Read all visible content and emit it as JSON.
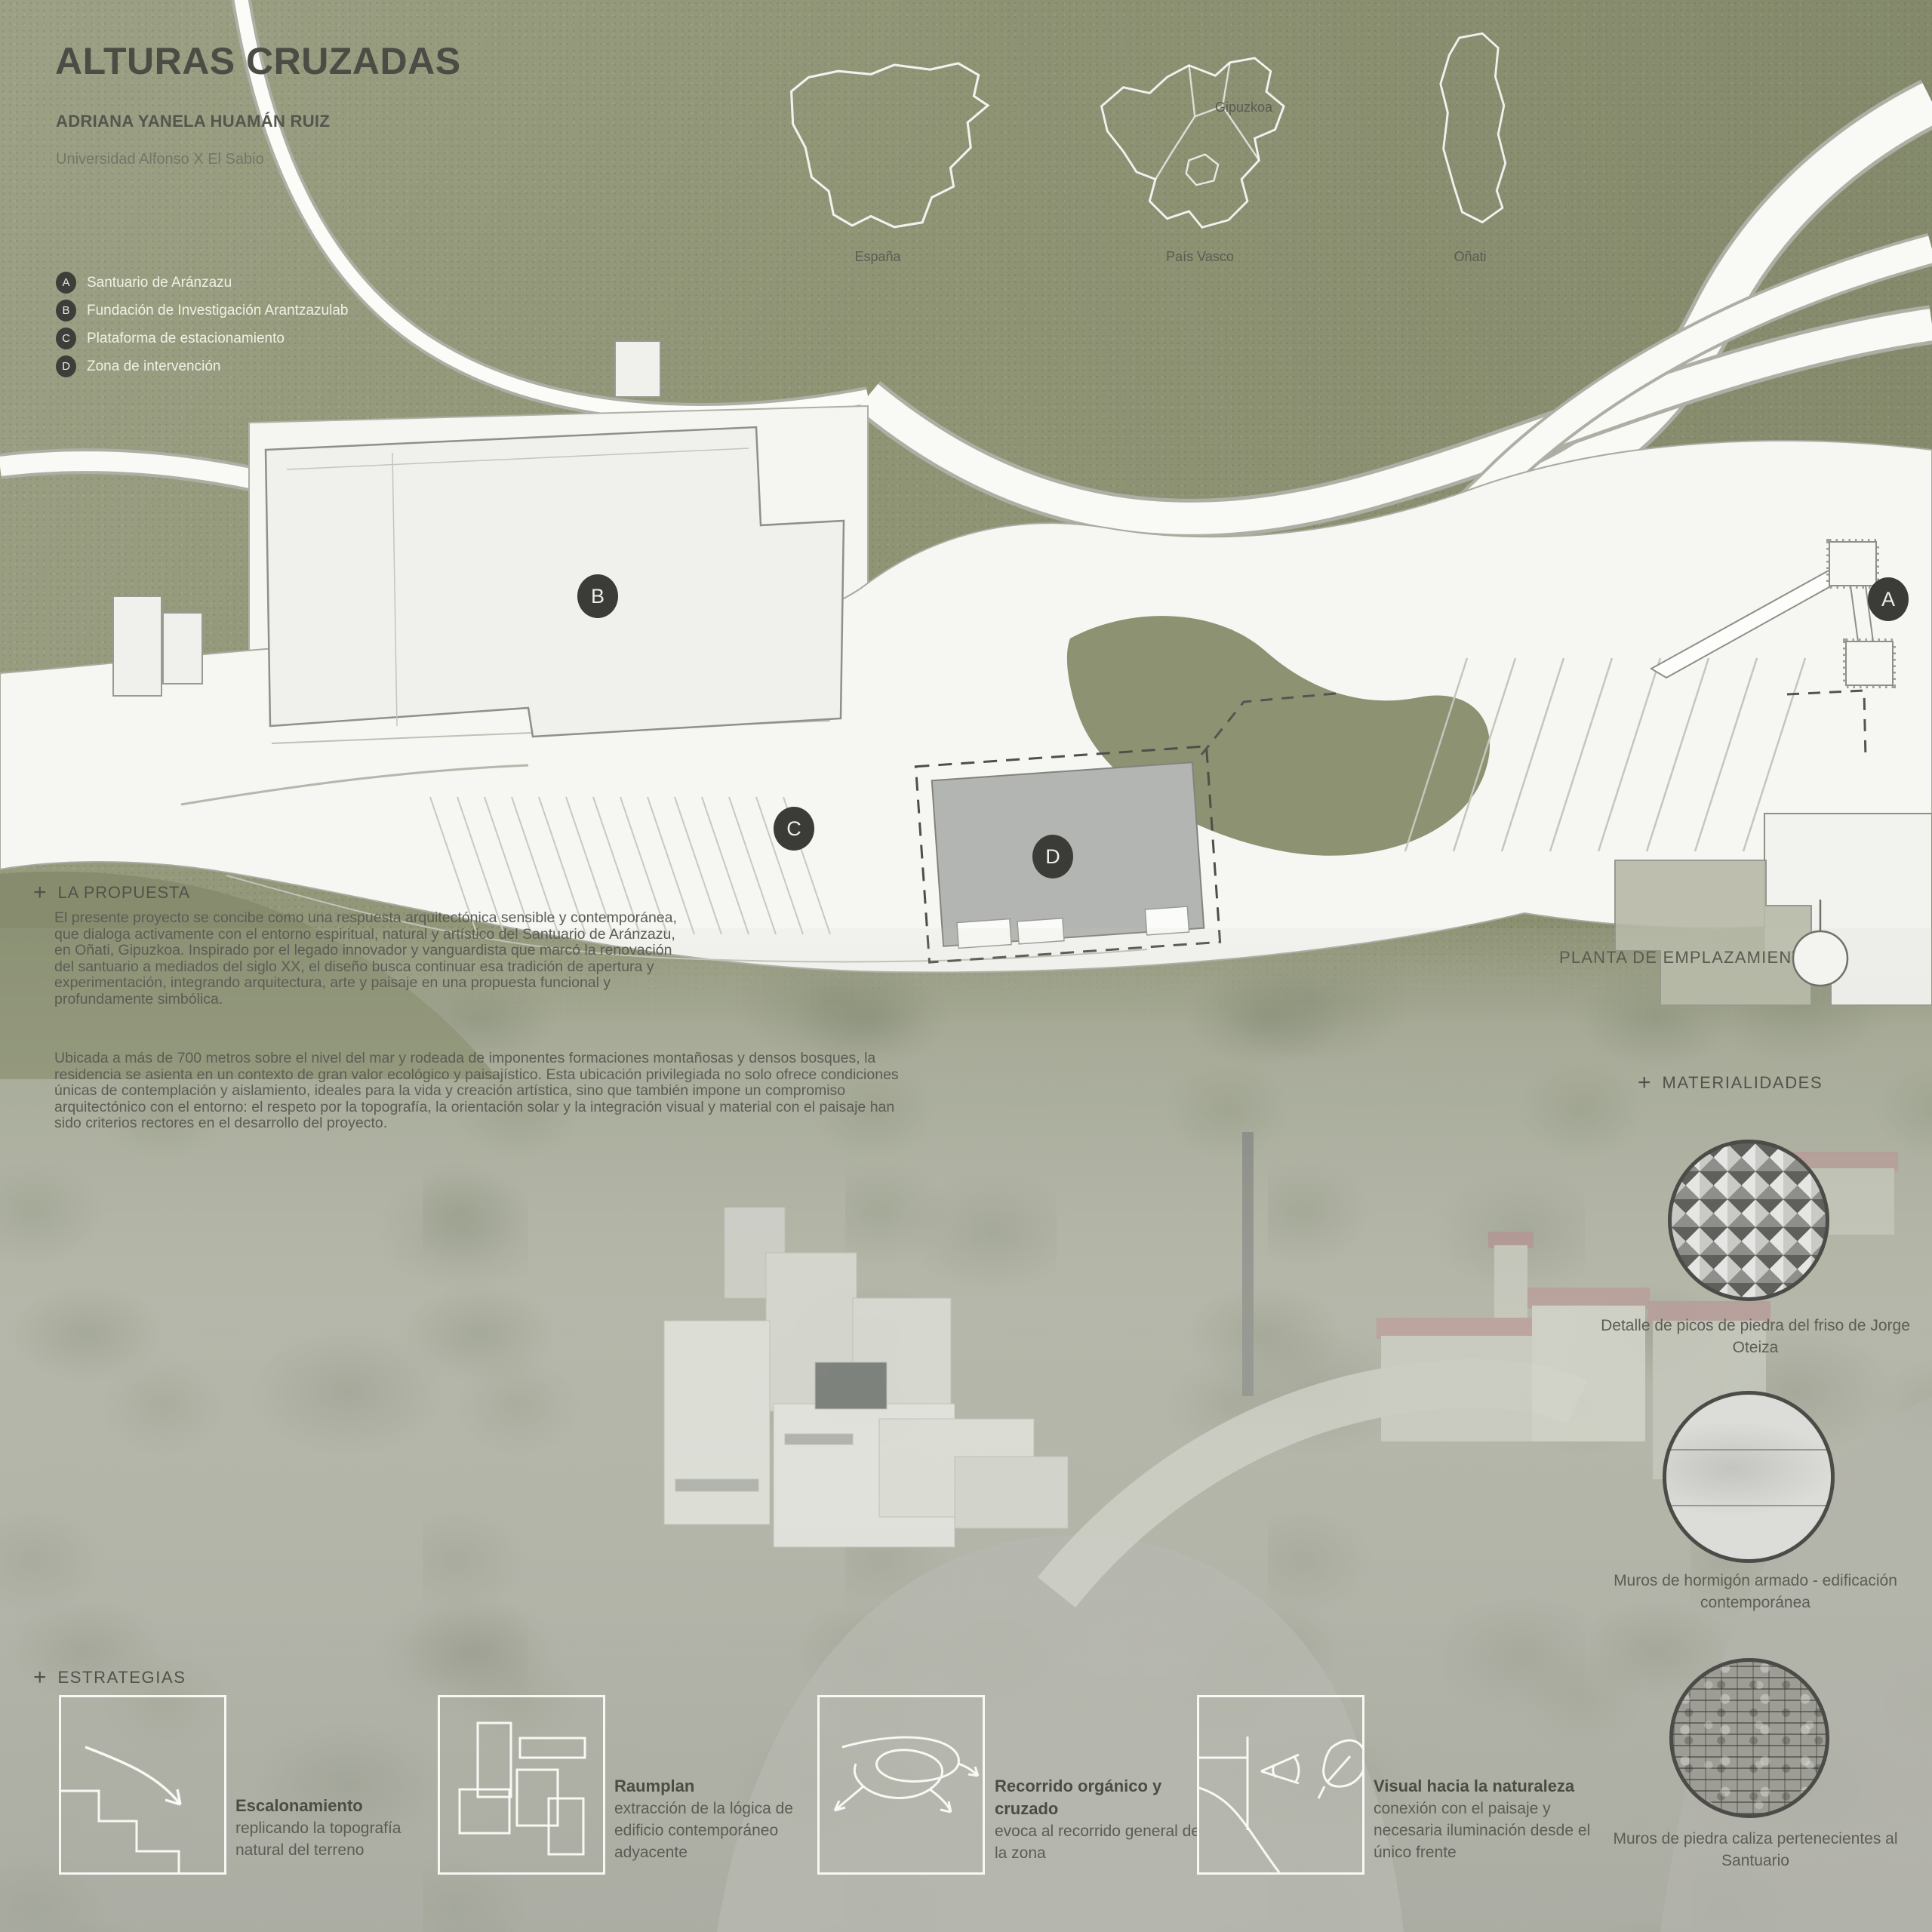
{
  "header": {
    "title": "ALTURAS CRUZADAS",
    "author": "ADRIANA YANELA HUAMÁN RUIZ",
    "university": "Universidad Alfonso X El Sabio"
  },
  "maps": {
    "gipuzkoa_label": "Gipuzkoa",
    "items": [
      {
        "label": "España"
      },
      {
        "label": "País Vasco"
      },
      {
        "label": "Oñati"
      }
    ]
  },
  "legend": {
    "items": [
      {
        "key": "A",
        "label": "Santuario de Aránzazu"
      },
      {
        "key": "B",
        "label": "Fundación de Investigación Arantzazulab"
      },
      {
        "key": "C",
        "label": "Plataforma de estacionamiento"
      },
      {
        "key": "D",
        "label": "Zona de intervención"
      }
    ]
  },
  "plan": {
    "caption": "PLANTA DE EMPLAZAMIENTO",
    "markers": [
      {
        "key": "A"
      },
      {
        "key": "B"
      },
      {
        "key": "C"
      },
      {
        "key": "D"
      }
    ]
  },
  "proposal": {
    "plus": "+",
    "heading": "LA PROPUESTA",
    "paragraphs": [
      "El presente proyecto se concibe como una respuesta arquitectónica sensible y contemporánea, que dialoga activamente con el entorno espiritual, natural y artístico del Santuario de Aránzazu, en Oñati, Gipuzkoa. Inspirado por el legado innovador y vanguardista que marcó la renovación del santuario a mediados del siglo XX, el diseño busca continuar esa tradición de apertura y experimentación, integrando arquitectura, arte y paisaje en una propuesta funcional y profundamente simbólica.",
      "Ubicada a más de 700 metros sobre el nivel del mar y rodeada de imponentes formaciones montañosas y densos bosques, la residencia se asienta en un contexto de gran valor ecológico y paisajístico. Esta ubicación privilegiada no solo ofrece condiciones únicas de contemplación y aislamiento, ideales para la vida y creación artística, sino que también impone un compromiso arquitectónico con el entorno: el respeto por la topografía, la orientación solar y la integración visual y material con el paisaje han sido criterios rectores en el desarrollo del proyecto."
    ]
  },
  "materials": {
    "plus": "+",
    "heading": "MATERIALIDADES",
    "items": [
      {
        "caption": "Detalle de picos de piedra del friso de Jorge Oteiza"
      },
      {
        "caption": "Muros de hormigón armado - edificación contemporánea"
      },
      {
        "caption": "Muros de piedra caliza pertenecientes al Santuario"
      }
    ]
  },
  "strategies": {
    "plus": "+",
    "heading": "ESTRATEGIAS",
    "items": [
      {
        "title": "Escalonamiento",
        "desc": "replicando la topografía natural del terreno"
      },
      {
        "title": "Raumplan",
        "desc": "extracción de la lógica de edificio contemporáneo adyacente"
      },
      {
        "title": "Recorrido orgánico y cruzado",
        "desc": "evoca al recorrido general de la zona"
      },
      {
        "title": "Visual hacia la naturaleza",
        "desc": "conexión con el paisaje y necesaria iluminación desde el único frente"
      }
    ]
  },
  "colors": {
    "background_green": "#8f9475",
    "plan_white": "#f6f6f3",
    "marker_dark": "#3b3b37",
    "roof_red": "#b28a89",
    "text_dark": "#55554e",
    "text_light": "#eff1e5"
  }
}
